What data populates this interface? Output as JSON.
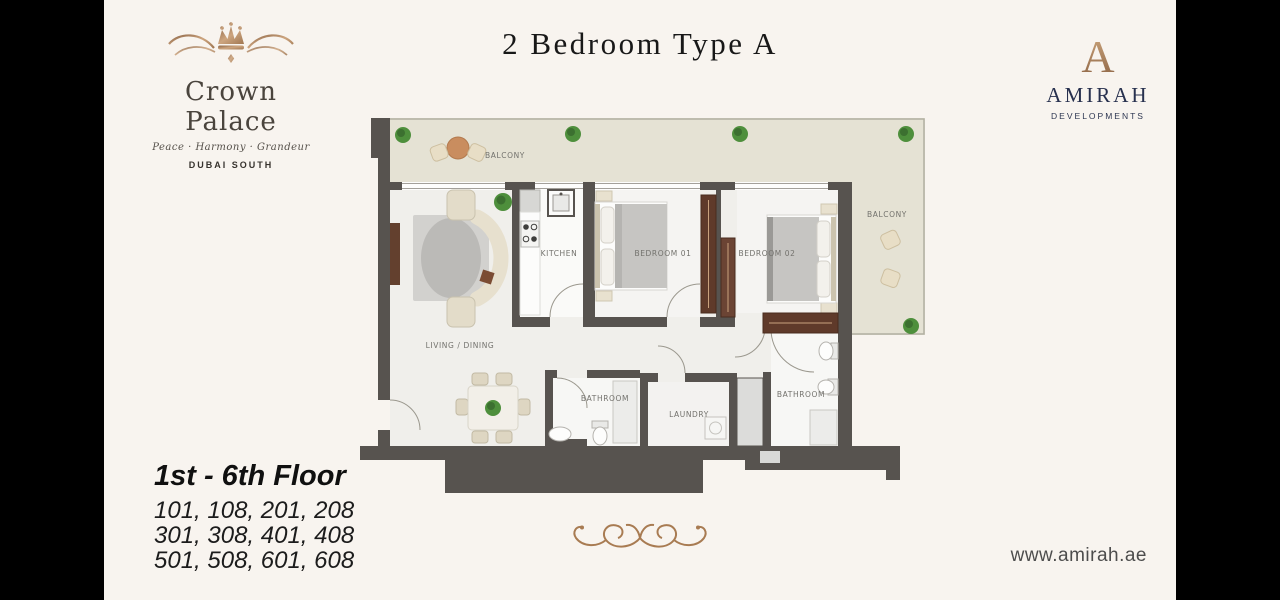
{
  "slide": {
    "background": "#f8f4ef",
    "letterbox": "#000000"
  },
  "title": "2 Bedroom Type A",
  "brand": {
    "name": "Crown Palace",
    "tagline": "Peace · Harmony · Grandeur",
    "location": "DUBAI SOUTH",
    "gold": "#b08a66"
  },
  "developer": {
    "monogram": "A",
    "name": "AMIRAH",
    "subtitle": "DEVELOPMENTS",
    "navy": "#27304e",
    "website": "www.amirah.ae"
  },
  "floor_info": {
    "heading": "1st - 6th Floor",
    "unit_lines": [
      "101, 108, 201, 208",
      "301, 308, 401, 408",
      "501, 508, 601, 608"
    ]
  },
  "floorplan": {
    "labels": {
      "balcony_top": "BALCONY",
      "balcony_right": "BALCONY",
      "kitchen": "KITCHEN",
      "bedroom_01": "BEDROOM 01",
      "bedroom_02": "BEDROOM 02",
      "living_dining": "LIVING / DINING",
      "bathroom_1": "BATHROOM",
      "bathroom_2": "BATHROOM",
      "laundry": "LAUNDRY"
    },
    "colors": {
      "wall": "#57534f",
      "balcony_floor": "#e5e2d4",
      "interior_floor": "#f0efeb",
      "wood": "#63402e",
      "plant": "#4e8f3c"
    }
  }
}
